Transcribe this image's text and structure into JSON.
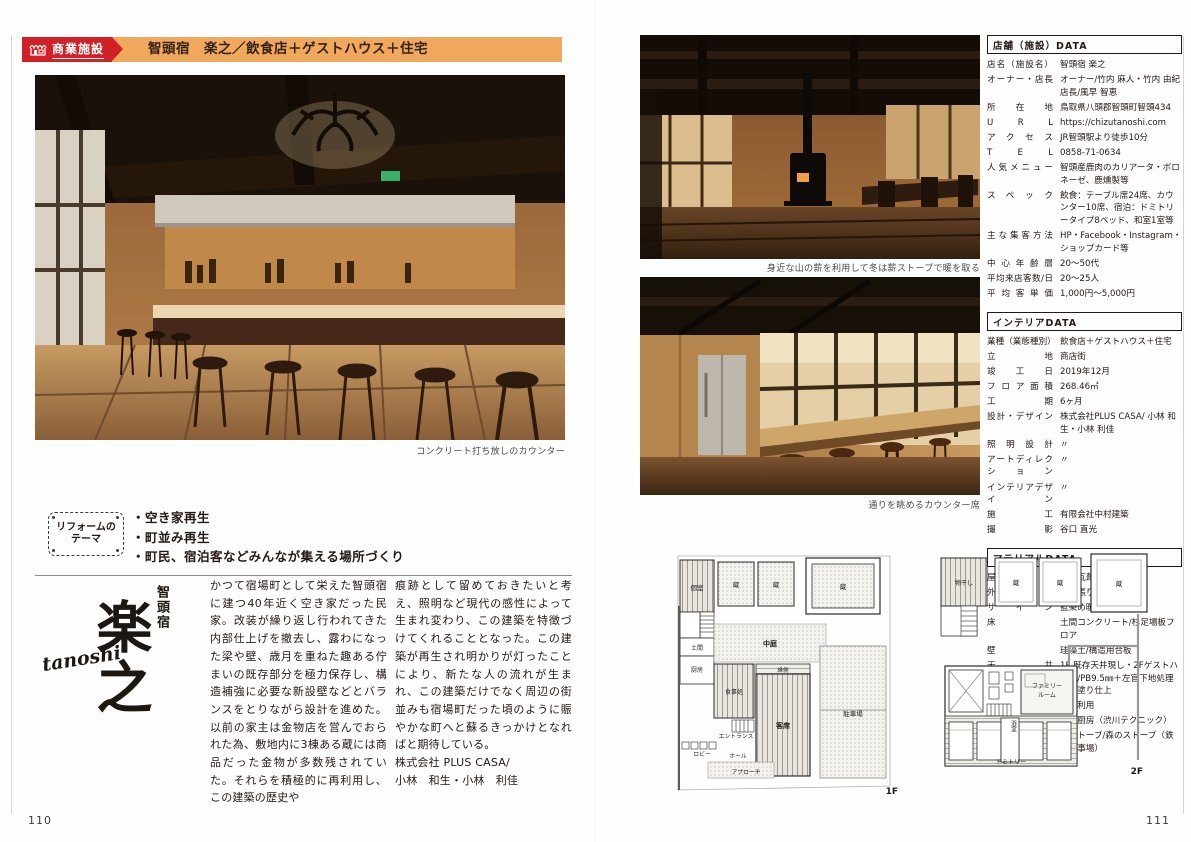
{
  "colors": {
    "accent_red": "#d12026",
    "banner_orange": "#f0a85c",
    "ink": "#231815",
    "caption_gray": "#4a4a4a"
  },
  "left": {
    "page_number": "110",
    "header": {
      "category": "商業施設",
      "title": "智頭宿　楽之／飲食店＋ゲストハウス＋住宅"
    },
    "photo_caption": "コンクリート打ち放しのカウンター",
    "reform": {
      "badge_line1": "リフォームの",
      "badge_line2": "テーマ",
      "items": [
        "・空き家再生",
        "・町並み再生",
        "・町民、宿泊客などみんなが集える場所づくり"
      ]
    },
    "logo": {
      "region": "智頭宿",
      "name": "楽之",
      "romaji": "tanoshi"
    },
    "body": {
      "col1": "かつて宿場町として栄えた智頭宿に建つ40年近く空き家だった民家。改装が繰り返し行われてきた内部仕上げを撤去し、露わになった梁や壁、歳月を重ねた趣ある佇まいの既存部分を極力保存し、構造補強に必要な新設壁などとバランスをとりながら設計を進めた。以前の家主は金物店を営んでおられた為、敷地内に3棟ある蔵には商品だった金物が多数残されていた。それらを積極的に再利用し、この建築の歴史や",
      "col2": "痕跡として留めておきたいと考え、照明など現代の感性によって生まれ変わり、この建築を特徴づけてくれることとなった。この建築が再生され明かりが灯ったことにより、新たな人の流れが生まれ、この建築だけでなく周辺の街並みも宿場町だった頃のように賑やかな町へと蘇るきっかけとなればと期待している。\n株式会社 PLUS CASA/\n小林　和生・小林　利佳"
    }
  },
  "right": {
    "page_number": "111",
    "photo1_caption": "身近な山の薪を利用して冬は薪ストーブで暖を取る",
    "photo2_caption": "通りを眺めるカウンター席",
    "sections": {
      "shop": {
        "title": "店舗（施設）DATA",
        "rows": [
          {
            "label": "店名（施設名）",
            "value": "智頭宿 楽之"
          },
          {
            "label": "オーナー・店長",
            "value": "オーナー/竹内 麻人・竹内 由紀　店長/風早 智恵"
          },
          {
            "label": "所在地",
            "value": "鳥取県八頭郡智頭町智頭434"
          },
          {
            "label": "U R L",
            "value": "https://chizutanoshi.com"
          },
          {
            "label": "アクセス",
            "value": "JR智頭駅より徒歩10分"
          },
          {
            "label": "T E L",
            "value": "0858-71-0634"
          },
          {
            "label": "人気メニュー",
            "value": "智頭産鹿肉のカリアータ・ボロネーゼ、鹿燻製等"
          },
          {
            "label": "スペック",
            "value": "飲食：テーブル席24席、カウンター10席、宿泊：ドミトリータイプ8ベッド、和室1室等"
          },
          {
            "label": "主な集客方法",
            "value": "HP・Facebook・Instagram・ショップカード等"
          },
          {
            "label": "中心年齢層",
            "value": "20～50代"
          },
          {
            "label": "平均来店客数/日",
            "value": "20～25人"
          },
          {
            "label": "平均客単価",
            "value": "1,000円～5,000円"
          }
        ]
      },
      "interior": {
        "title": "インテリアDATA",
        "rows": [
          {
            "label": "業種（業態種別）",
            "value": "飲食店＋ゲストハウス＋住宅"
          },
          {
            "label": "立地",
            "value": "商店街"
          },
          {
            "label": "竣工日",
            "value": "2019年12月"
          },
          {
            "label": "フロア面積",
            "value": "268.46㎡"
          },
          {
            "label": "工期",
            "value": "6ヶ月"
          },
          {
            "label": "設計・デザイン",
            "value": "株式会社PLUS CASA/ 小林 和生・小林 利佳"
          },
          {
            "label": "照明設計",
            "value": "〃"
          },
          {
            "label": "アートディレクション",
            "value": "〃"
          },
          {
            "label": "インテリアデザイン",
            "value": "〃"
          },
          {
            "label": "施工",
            "value": "有限会社中村建築"
          },
          {
            "label": "撮影",
            "value": "谷口 直光"
          }
        ]
      },
      "material": {
        "title": "マテリアルDATA",
        "rows": [
          {
            "label": "屋根",
            "value": "石州瓦葺き"
          },
          {
            "label": "外壁",
            "value": "杉板張り/漆喰壁"
          },
          {
            "label": "サイン",
            "value": "藍染め暖簾"
          },
          {
            "label": "床",
            "value": "土間コンクリート/杉足場板フロア"
          },
          {
            "label": "壁",
            "value": "珪藻土/構造用合板"
          },
          {
            "label": "天井",
            "value": "1F 既存天井現し・2Fゲストハウス/PB9.5㎜＋左官下地処理の中塗り仕上"
          },
          {
            "label": "家具・展示什器",
            "value": "既存利用"
          },
          {
            "label": "厨房什器",
            "value": "造作厨房（渋川テクニック）"
          },
          {
            "label": "厨房機器",
            "value": "薪ストーブ/森のストーブ（鉄の仕事場）"
          }
        ]
      }
    },
    "plans": {
      "f1": {
        "label": "1F",
        "rooms": {
          "private": "個室",
          "doma": "土間",
          "kitchen": "厨房",
          "dining": "食事処",
          "courtyard": "中庭",
          "engawa": "縁側",
          "seating": "客席",
          "kura": "蔵",
          "parking": "駐車場",
          "entrance": "エントランス",
          "lobby": "ロビー",
          "hall": "ホール",
          "approach": "アプローチ"
        }
      },
      "f2": {
        "label": "2F",
        "rooms": {
          "laundry": "物干し",
          "kura": "蔵",
          "family_line1": "ファミリー",
          "family_line2": "ルーム",
          "bath": "浴室",
          "dormitory": "ドミトリー"
        }
      }
    }
  }
}
